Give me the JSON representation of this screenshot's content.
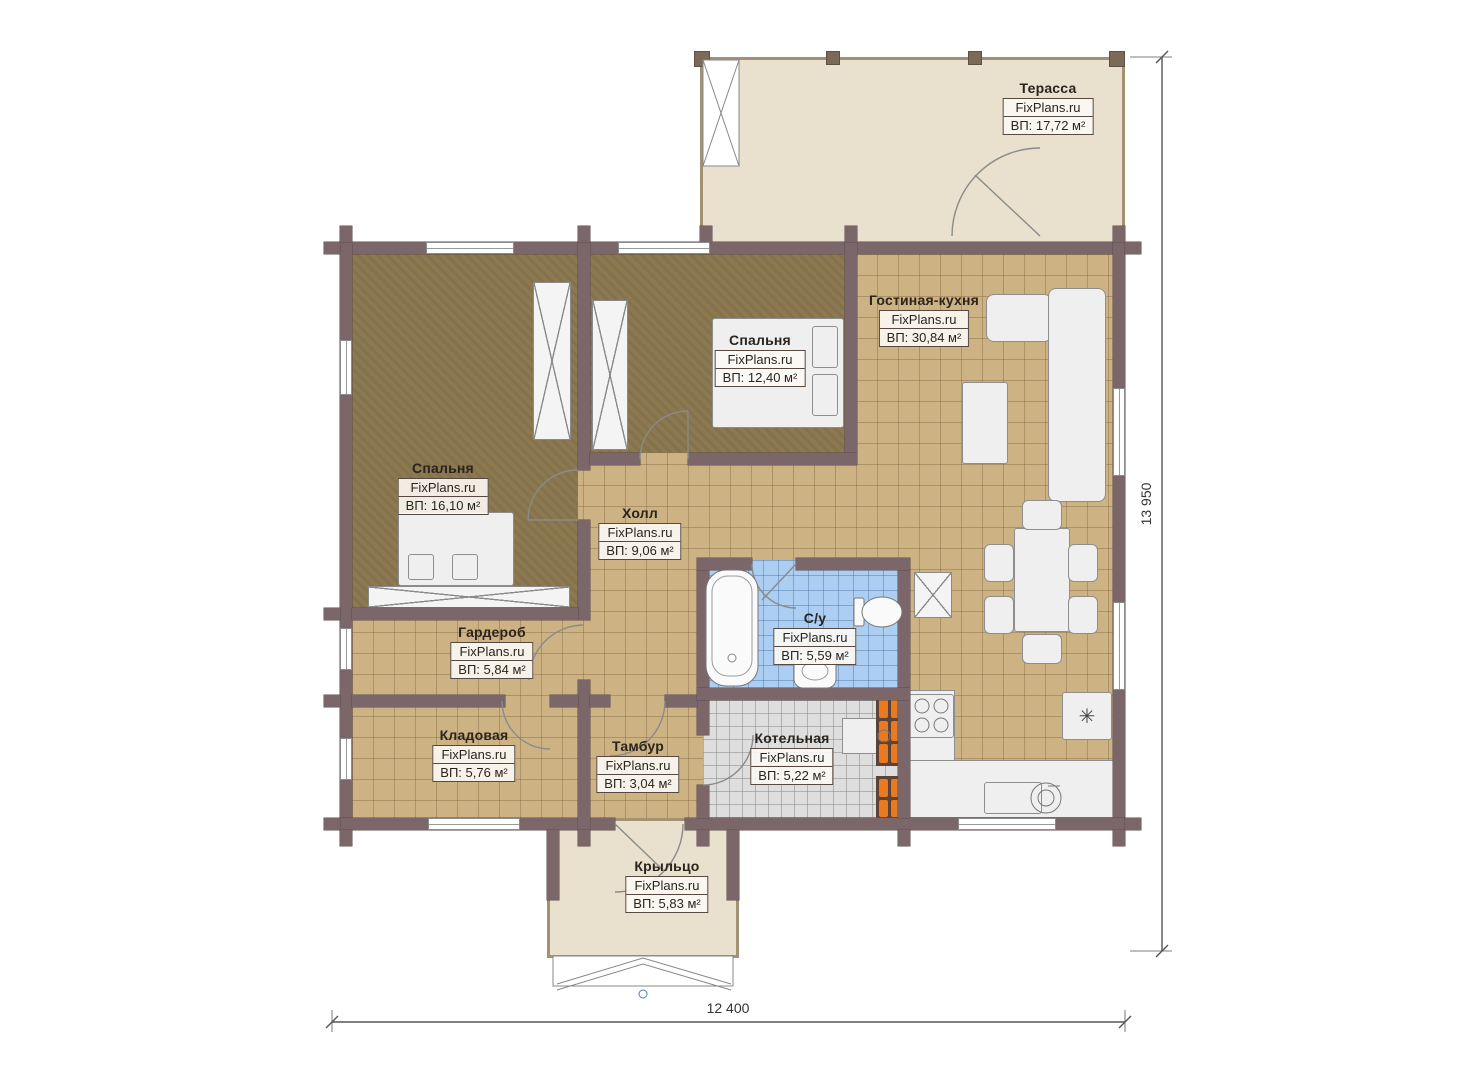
{
  "plan": {
    "site": "FixPlans.ru",
    "rooms": [
      {
        "name": "Терасса",
        "brand": "FixPlans.ru",
        "area": "ВП: 17,72 м²"
      },
      {
        "name": "Гостиная-кухня",
        "brand": "FixPlans.ru",
        "area": "ВП: 30,84 м²"
      },
      {
        "name": "Спальня",
        "brand": "FixPlans.ru",
        "area": "ВП: 12,40 м²"
      },
      {
        "name": "Спальня",
        "brand": "FixPlans.ru",
        "area": "ВП: 16,10 м²"
      },
      {
        "name": "Холл",
        "brand": "FixPlans.ru",
        "area": "ВП: 9,06 м²"
      },
      {
        "name": "Гардероб",
        "brand": "FixPlans.ru",
        "area": "ВП: 5,84 м²"
      },
      {
        "name": "С/у",
        "brand": "FixPlans.ru",
        "area": "ВП: 5,59 м²"
      },
      {
        "name": "Кладовая",
        "brand": "FixPlans.ru",
        "area": "ВП: 5,76 м²"
      },
      {
        "name": "Тамбур",
        "brand": "FixPlans.ru",
        "area": "ВП: 3,04 м²"
      },
      {
        "name": "Котельная",
        "brand": "FixPlans.ru",
        "area": "ВП: 5,22 м²"
      },
      {
        "name": "Крыльцо",
        "brand": "FixPlans.ru",
        "area": "ВП: 5,83 м²"
      }
    ],
    "dimensions": {
      "width": "12 400",
      "height": "13 950"
    },
    "icons": {
      "fridge": "✳"
    },
    "colors": {
      "wall": "#7b6669",
      "floor_tile": "#cdb284",
      "floor_carpet": "#8c7951",
      "floor_bath": "#abcef2",
      "floor_boiler": "#dedede",
      "deck": "#e9e0cd",
      "radiator": "#e97a1f"
    }
  }
}
